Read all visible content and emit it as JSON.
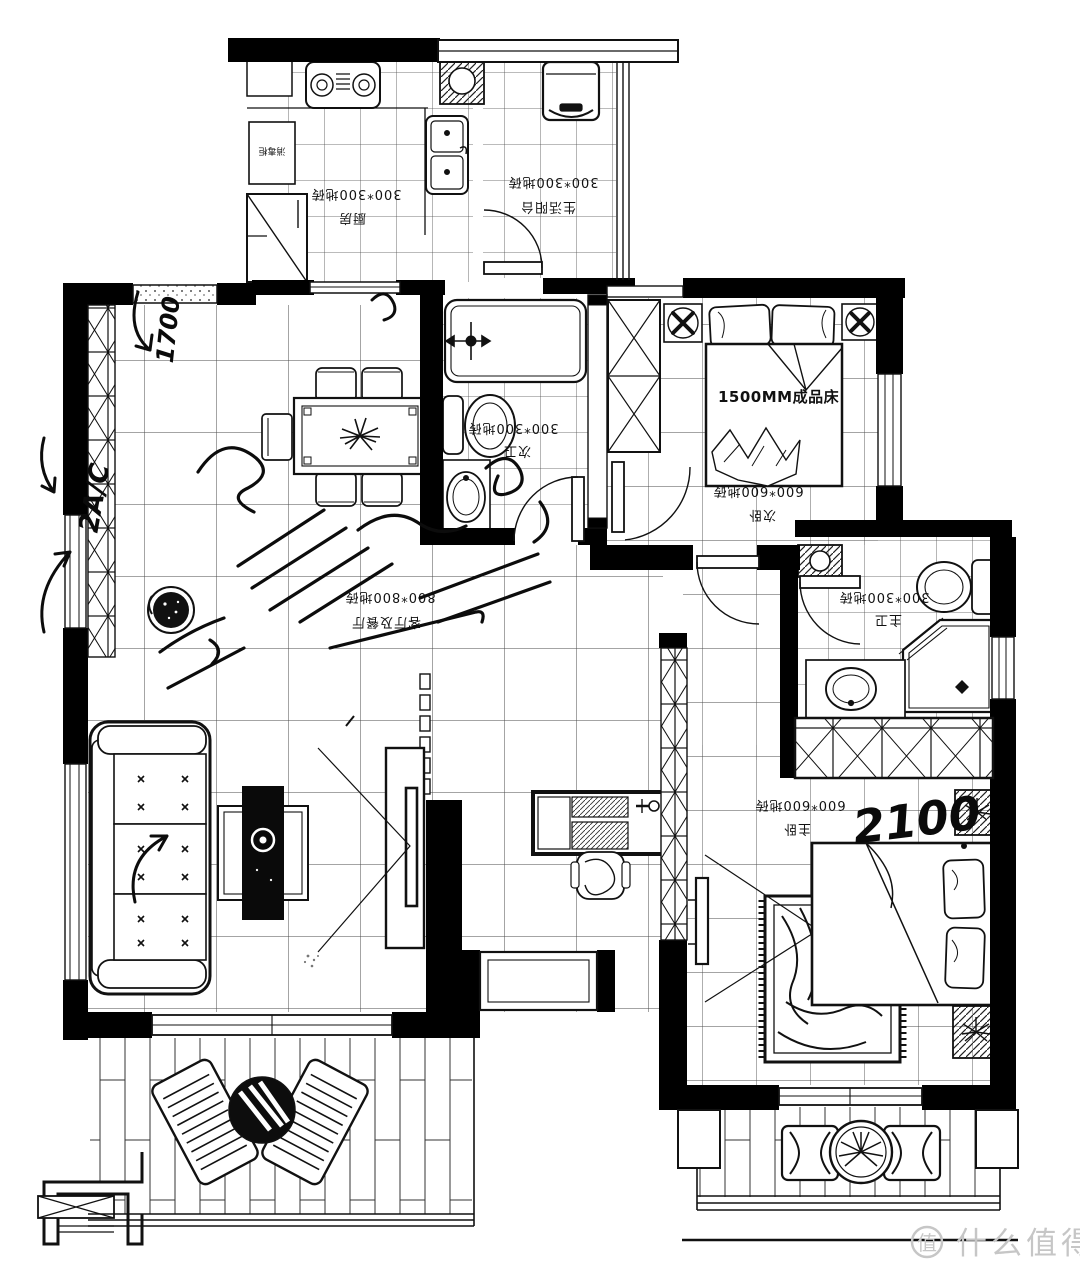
{
  "rooms": {
    "kitchen": {
      "tile": "300*300地砖",
      "name": "厨房"
    },
    "service_balcony": {
      "tile": "300*300地砖",
      "name": "生活阳台"
    },
    "second_bath": {
      "tile": "300*300地砖",
      "name": "次卫"
    },
    "second_bedroom": {
      "tile": "600*600地砖",
      "name": "次卧",
      "bed_label": "1500MM成品床"
    },
    "living_dining": {
      "tile": "800*800地砖",
      "name": "客厅及餐厅"
    },
    "master_bath": {
      "tile": "300*300地砖",
      "name": "主卫"
    },
    "master_bedroom": {
      "tile": "600*600地砖",
      "name": "主卧"
    }
  },
  "labels": {
    "sterilizer_cabinet": "消毒柜"
  },
  "handwriting": {
    "dim_1700": "1700",
    "ac_note": "2A/C",
    "dim_2100": "2100"
  },
  "watermark": {
    "badge": "值",
    "text": "什么值得买"
  }
}
